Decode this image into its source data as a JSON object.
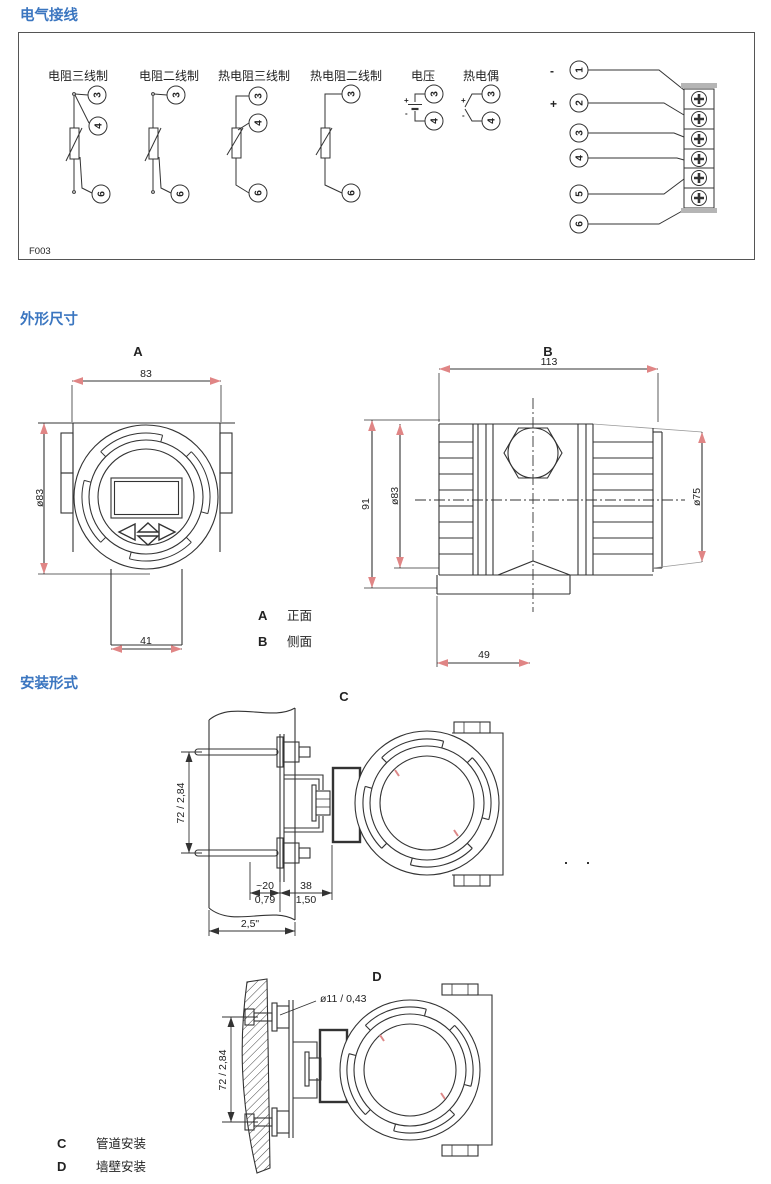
{
  "wiring": {
    "title": "电气接线",
    "figure_code": "F003",
    "labels": [
      "电阻三线制",
      "电阻二线制",
      "热电阻三线制",
      "热电阻二线制",
      "电压",
      "热电偶"
    ],
    "signs": {
      "plus": "+",
      "minus": "-"
    },
    "terminals": {
      "n1": "1",
      "n2": "2",
      "n3": "3",
      "n4": "4",
      "n5": "5",
      "n6": "6"
    }
  },
  "dims": {
    "title": "外形尺寸",
    "viewA": {
      "label": "A",
      "width": "83",
      "diameter": "ø83",
      "neck_width": "41"
    },
    "viewB": {
      "label": "B",
      "width": "113",
      "height": "91",
      "diameter": "ø83",
      "rear_diameter": "ø75",
      "conduit_offset": "49"
    },
    "legend": [
      {
        "key": "A",
        "value": "正面"
      },
      {
        "key": "B",
        "value": "侧面"
      }
    ]
  },
  "mount": {
    "title": "安装形式",
    "viewC": {
      "label": "C",
      "bolt_spacing": "72 / 2,84",
      "pipe_offset_mm": "~20",
      "pipe_offset_in": "0,79",
      "bracket_depth_mm": "38",
      "bracket_depth_in": "1,50",
      "pipe_size": "2,5\""
    },
    "viewD": {
      "label": "D",
      "hole_diameter": "ø11 / 0,43",
      "bolt_spacing": "72 / 2,84"
    },
    "legend": [
      {
        "key": "C",
        "value": "管道安装"
      },
      {
        "key": "D",
        "value": "墙壁安装"
      }
    ]
  },
  "colors": {
    "heading": "#3b76c0",
    "line": "#333333",
    "pink_arrow": "#e08585"
  }
}
